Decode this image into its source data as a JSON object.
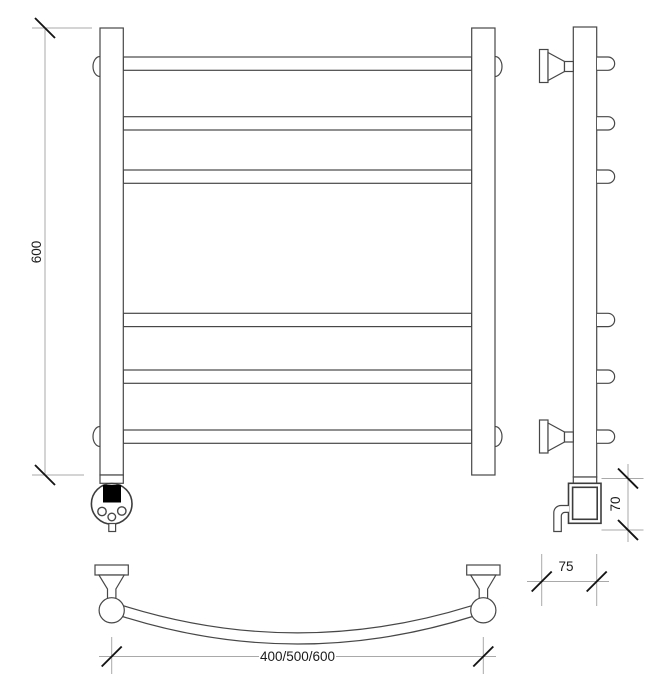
{
  "drawing": {
    "subject": "technical drawing of a curved ladder towel rail with electric heating element: front view, side view, top view",
    "labels": {
      "height": "600",
      "element_height": "70",
      "wall_depth": "75",
      "widths": "400/500/600"
    },
    "front_view": {
      "bar_count": 6,
      "bar_y_positions": [
        57,
        116.7,
        170,
        313.3,
        370,
        430
      ],
      "bar_thickness": 13.3,
      "bar_x": 123.3,
      "bar_width": 348.4
    },
    "colors": {
      "background": "#ffffff",
      "object_line": "#474747",
      "dimension_line": "#a9a9a9",
      "tick_line": "#141414",
      "text": "#1c1c1c",
      "display_fill": "#000000"
    }
  }
}
